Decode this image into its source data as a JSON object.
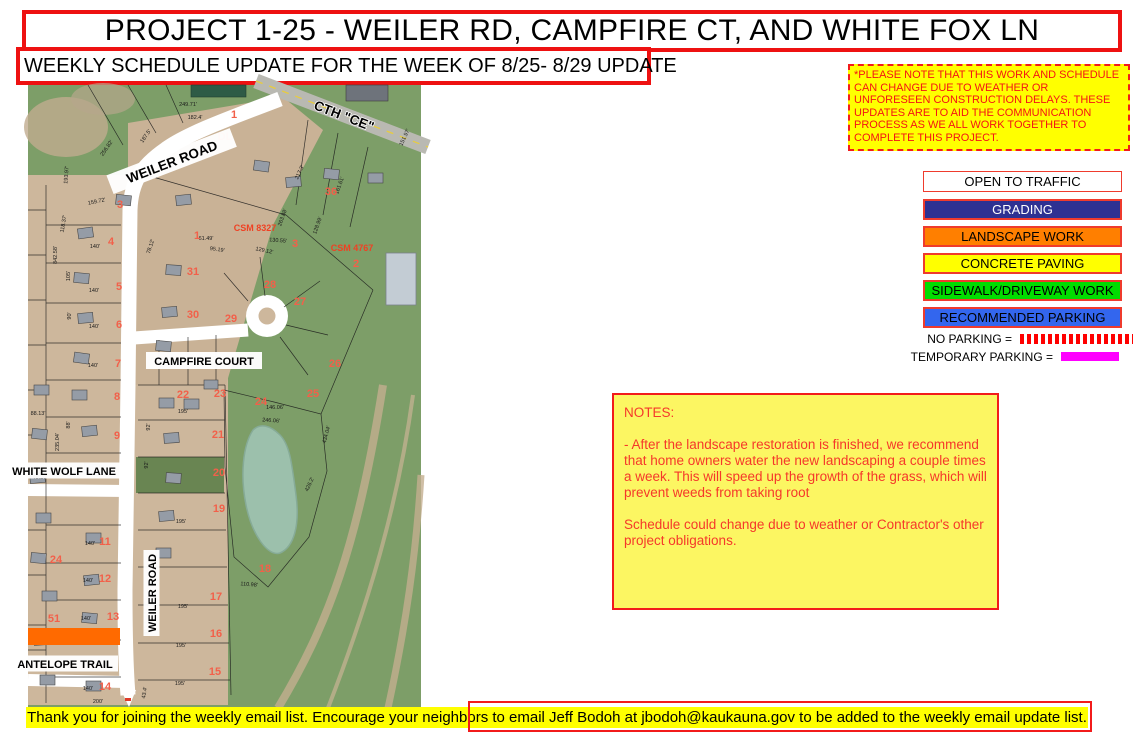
{
  "header": {
    "title": "PROJECT 1-25 - WEILER RD, CAMPFIRE CT, AND WHITE FOX LN",
    "subtitle": "WEEKLY SCHEDULE UPDATE FOR THE WEEK OF 8/25- 8/29 UPDATE"
  },
  "notice": {
    "text": "*PLEASE NOTE THAT THIS WORK AND SCHEDULE CAN CHANGE DUE TO WEATHER OR UNFORESEEN CONSTRUCTION DELAYS. THESE UPDATES ARE TO AID THE COMMUNICATION PROCESS AS WE ALL WORK TOGETHER TO COMPLETE THIS PROJECT.",
    "bg": "#FFFF00",
    "text_color": "#FF0000"
  },
  "legend": {
    "items": [
      {
        "label": "OPEN TO TRAFFIC",
        "bg": "#FFFFFF",
        "color": "#000000"
      },
      {
        "label": "GRADING",
        "bg": "#2E3192",
        "color": "#FFFFFF"
      },
      {
        "label": "LANDSCAPE WORK",
        "bg": "#FF7F00",
        "color": "#000000"
      },
      {
        "label": "CONCRETE PAVING",
        "bg": "#FFFF00",
        "color": "#000000"
      },
      {
        "label": "SIDEWALK/DRIVEWAY WORK",
        "bg": "#00DD00",
        "color": "#000000"
      },
      {
        "label": "RECOMMENDED PARKING",
        "bg": "#3366EE",
        "color": "#000000"
      }
    ]
  },
  "parking": {
    "no_parking_label": "NO PARKING =",
    "temporary_parking_label": "TEMPORARY PARKING =",
    "no_parking_color": "#FF0000",
    "temporary_parking_color": "#FF00FF"
  },
  "notes": {
    "heading": "NOTES:",
    "p1": "- After the landscape restoration is finished, we recommend that home owners water the new landscaping a couple times a week. This will speed up the growth of the grass, which will prevent weeds from taking root",
    "p2": "Schedule could change due to weather or Contractor's other project obligations."
  },
  "footer": {
    "text": "Thank you for joining the weekly email list. Encourage your neighbors to email Jeff Bodoh at jbodoh@kaukauna.gov to be added to the weekly email update list."
  },
  "map": {
    "road_labels": {
      "weiler_top": "WEILER ROAD",
      "cth_ce": "CTH \"CE\"",
      "campfire_court": "CAMPFIRE COURT",
      "white_wolf_lane": "WHITE WOLF LANE",
      "weiler_side": "WEILER ROAD",
      "antelope_trail": "ANTELOPE TRAIL"
    },
    "survey_labels": {
      "csm_a": "CSM 8327",
      "csm_b": "CSM 4767"
    },
    "lot_numbers": [
      {
        "t": "1",
        "x": 206,
        "y": 33
      },
      {
        "t": "DL",
        "x": 197,
        "y": 55
      },
      {
        "t": "1",
        "x": 169,
        "y": 154
      },
      {
        "t": "3",
        "x": 92,
        "y": 123
      },
      {
        "t": "4",
        "x": 83,
        "y": 160
      },
      {
        "t": "5",
        "x": 91,
        "y": 205
      },
      {
        "t": "6",
        "x": 91,
        "y": 243
      },
      {
        "t": "7",
        "x": 90,
        "y": 282
      },
      {
        "t": "8",
        "x": 89,
        "y": 315
      },
      {
        "t": "9",
        "x": 89,
        "y": 354
      },
      {
        "t": "11",
        "x": 77,
        "y": 460
      },
      {
        "t": "12",
        "x": 77,
        "y": 497
      },
      {
        "t": "13",
        "x": 85,
        "y": 535
      },
      {
        "t": "14",
        "x": 77,
        "y": 605
      },
      {
        "t": "24",
        "x": 28,
        "y": 478
      },
      {
        "t": "51",
        "x": 26,
        "y": 537
      },
      {
        "t": "31",
        "x": 165,
        "y": 190
      },
      {
        "t": "30",
        "x": 165,
        "y": 233
      },
      {
        "t": "29",
        "x": 203,
        "y": 237
      },
      {
        "t": "28",
        "x": 242,
        "y": 203
      },
      {
        "t": "27",
        "x": 272,
        "y": 220
      },
      {
        "t": "26",
        "x": 307,
        "y": 282
      },
      {
        "t": "25",
        "x": 285,
        "y": 312
      },
      {
        "t": "24",
        "x": 233,
        "y": 320
      },
      {
        "t": "23",
        "x": 192,
        "y": 312
      },
      {
        "t": "22",
        "x": 155,
        "y": 313
      },
      {
        "t": "21",
        "x": 190,
        "y": 353
      },
      {
        "t": "20",
        "x": 191,
        "y": 391
      },
      {
        "t": "19",
        "x": 191,
        "y": 427
      },
      {
        "t": "18",
        "x": 237,
        "y": 487
      },
      {
        "t": "17",
        "x": 188,
        "y": 515
      },
      {
        "t": "16",
        "x": 188,
        "y": 552
      },
      {
        "t": "15",
        "x": 187,
        "y": 590
      },
      {
        "t": "36",
        "x": 303,
        "y": 110
      },
      {
        "t": "2",
        "x": 328,
        "y": 182
      },
      {
        "t": "3",
        "x": 267,
        "y": 162
      }
    ],
    "dimensions": [
      {
        "t": "249.71'",
        "x": 160,
        "y": 21,
        "r": 0
      },
      {
        "t": "182.4'",
        "x": 167,
        "y": 34,
        "r": 0
      },
      {
        "t": "256.82'",
        "x": 80,
        "y": 64,
        "r": -55
      },
      {
        "t": "187.5'",
        "x": 119,
        "y": 52,
        "r": -55
      },
      {
        "t": "193.97'",
        "x": 40,
        "y": 90,
        "r": -85
      },
      {
        "t": "159.72'",
        "x": 69,
        "y": 118,
        "r": -12
      },
      {
        "t": "118.37'",
        "x": 37,
        "y": 139,
        "r": -80
      },
      {
        "t": "842.58'",
        "x": 29,
        "y": 170,
        "r": -90
      },
      {
        "t": "140'",
        "x": 67,
        "y": 163,
        "r": 0
      },
      {
        "t": "105'",
        "x": 42,
        "y": 191,
        "r": -90
      },
      {
        "t": "140'",
        "x": 66,
        "y": 207,
        "r": 0
      },
      {
        "t": "90'",
        "x": 43,
        "y": 231,
        "r": -90
      },
      {
        "t": "140'",
        "x": 66,
        "y": 243,
        "r": 0
      },
      {
        "t": "140'",
        "x": 65,
        "y": 282,
        "r": 0
      },
      {
        "t": "78.12'",
        "x": 124,
        "y": 162,
        "r": -72
      },
      {
        "t": "61.49'",
        "x": 178,
        "y": 155,
        "r": 0
      },
      {
        "t": "95.19'",
        "x": 189,
        "y": 166,
        "r": 8
      },
      {
        "t": "129.12'",
        "x": 236,
        "y": 167,
        "r": 12
      },
      {
        "t": "130.55'",
        "x": 250,
        "y": 157,
        "r": 5
      },
      {
        "t": "217.3'",
        "x": 273,
        "y": 88,
        "r": -65
      },
      {
        "t": "151.97'",
        "x": 378,
        "y": 53,
        "r": -65
      },
      {
        "t": "161.61'",
        "x": 313,
        "y": 101,
        "r": -70
      },
      {
        "t": "263.88'",
        "x": 256,
        "y": 133,
        "r": -70
      },
      {
        "t": "128.99'",
        "x": 291,
        "y": 141,
        "r": -70
      },
      {
        "t": "195'",
        "x": 155,
        "y": 328,
        "r": 0
      },
      {
        "t": "92'",
        "x": 122,
        "y": 342,
        "r": -90
      },
      {
        "t": "92'",
        "x": 120,
        "y": 380,
        "r": -90
      },
      {
        "t": "195'",
        "x": 153,
        "y": 438,
        "r": 0
      },
      {
        "t": "246.06'",
        "x": 243,
        "y": 337,
        "r": 4
      },
      {
        "t": "146.06'",
        "x": 247,
        "y": 324,
        "r": 0
      },
      {
        "t": "110.98'",
        "x": 221,
        "y": 501,
        "r": 5
      },
      {
        "t": "195'",
        "x": 155,
        "y": 523,
        "r": 0
      },
      {
        "t": "195'",
        "x": 153,
        "y": 562,
        "r": 0
      },
      {
        "t": "195'",
        "x": 152,
        "y": 600,
        "r": 0
      },
      {
        "t": "140'",
        "x": 62,
        "y": 460,
        "r": 0
      },
      {
        "t": "140'",
        "x": 60,
        "y": 497,
        "r": 0
      },
      {
        "t": "140'",
        "x": 58,
        "y": 535,
        "r": 0
      },
      {
        "t": "140'",
        "x": 60,
        "y": 605,
        "r": 0
      },
      {
        "t": "88'",
        "x": 42,
        "y": 340,
        "r": -90
      },
      {
        "t": "91'",
        "x": 120,
        "y": 546,
        "r": -90
      },
      {
        "t": "43.4'",
        "x": 118,
        "y": 608,
        "r": -80
      },
      {
        "t": "200'",
        "x": 70,
        "y": 618,
        "r": 0
      },
      {
        "t": "88.13'",
        "x": 10,
        "y": 330,
        "r": 0
      },
      {
        "t": "48.20'",
        "x": 12,
        "y": 394,
        "r": 0
      },
      {
        "t": "235.04'",
        "x": 31,
        "y": 357,
        "r": -90
      },
      {
        "t": "426.2'",
        "x": 283,
        "y": 400,
        "r": -65
      },
      {
        "t": "434.04'",
        "x": 300,
        "y": 350,
        "r": -75
      }
    ]
  }
}
